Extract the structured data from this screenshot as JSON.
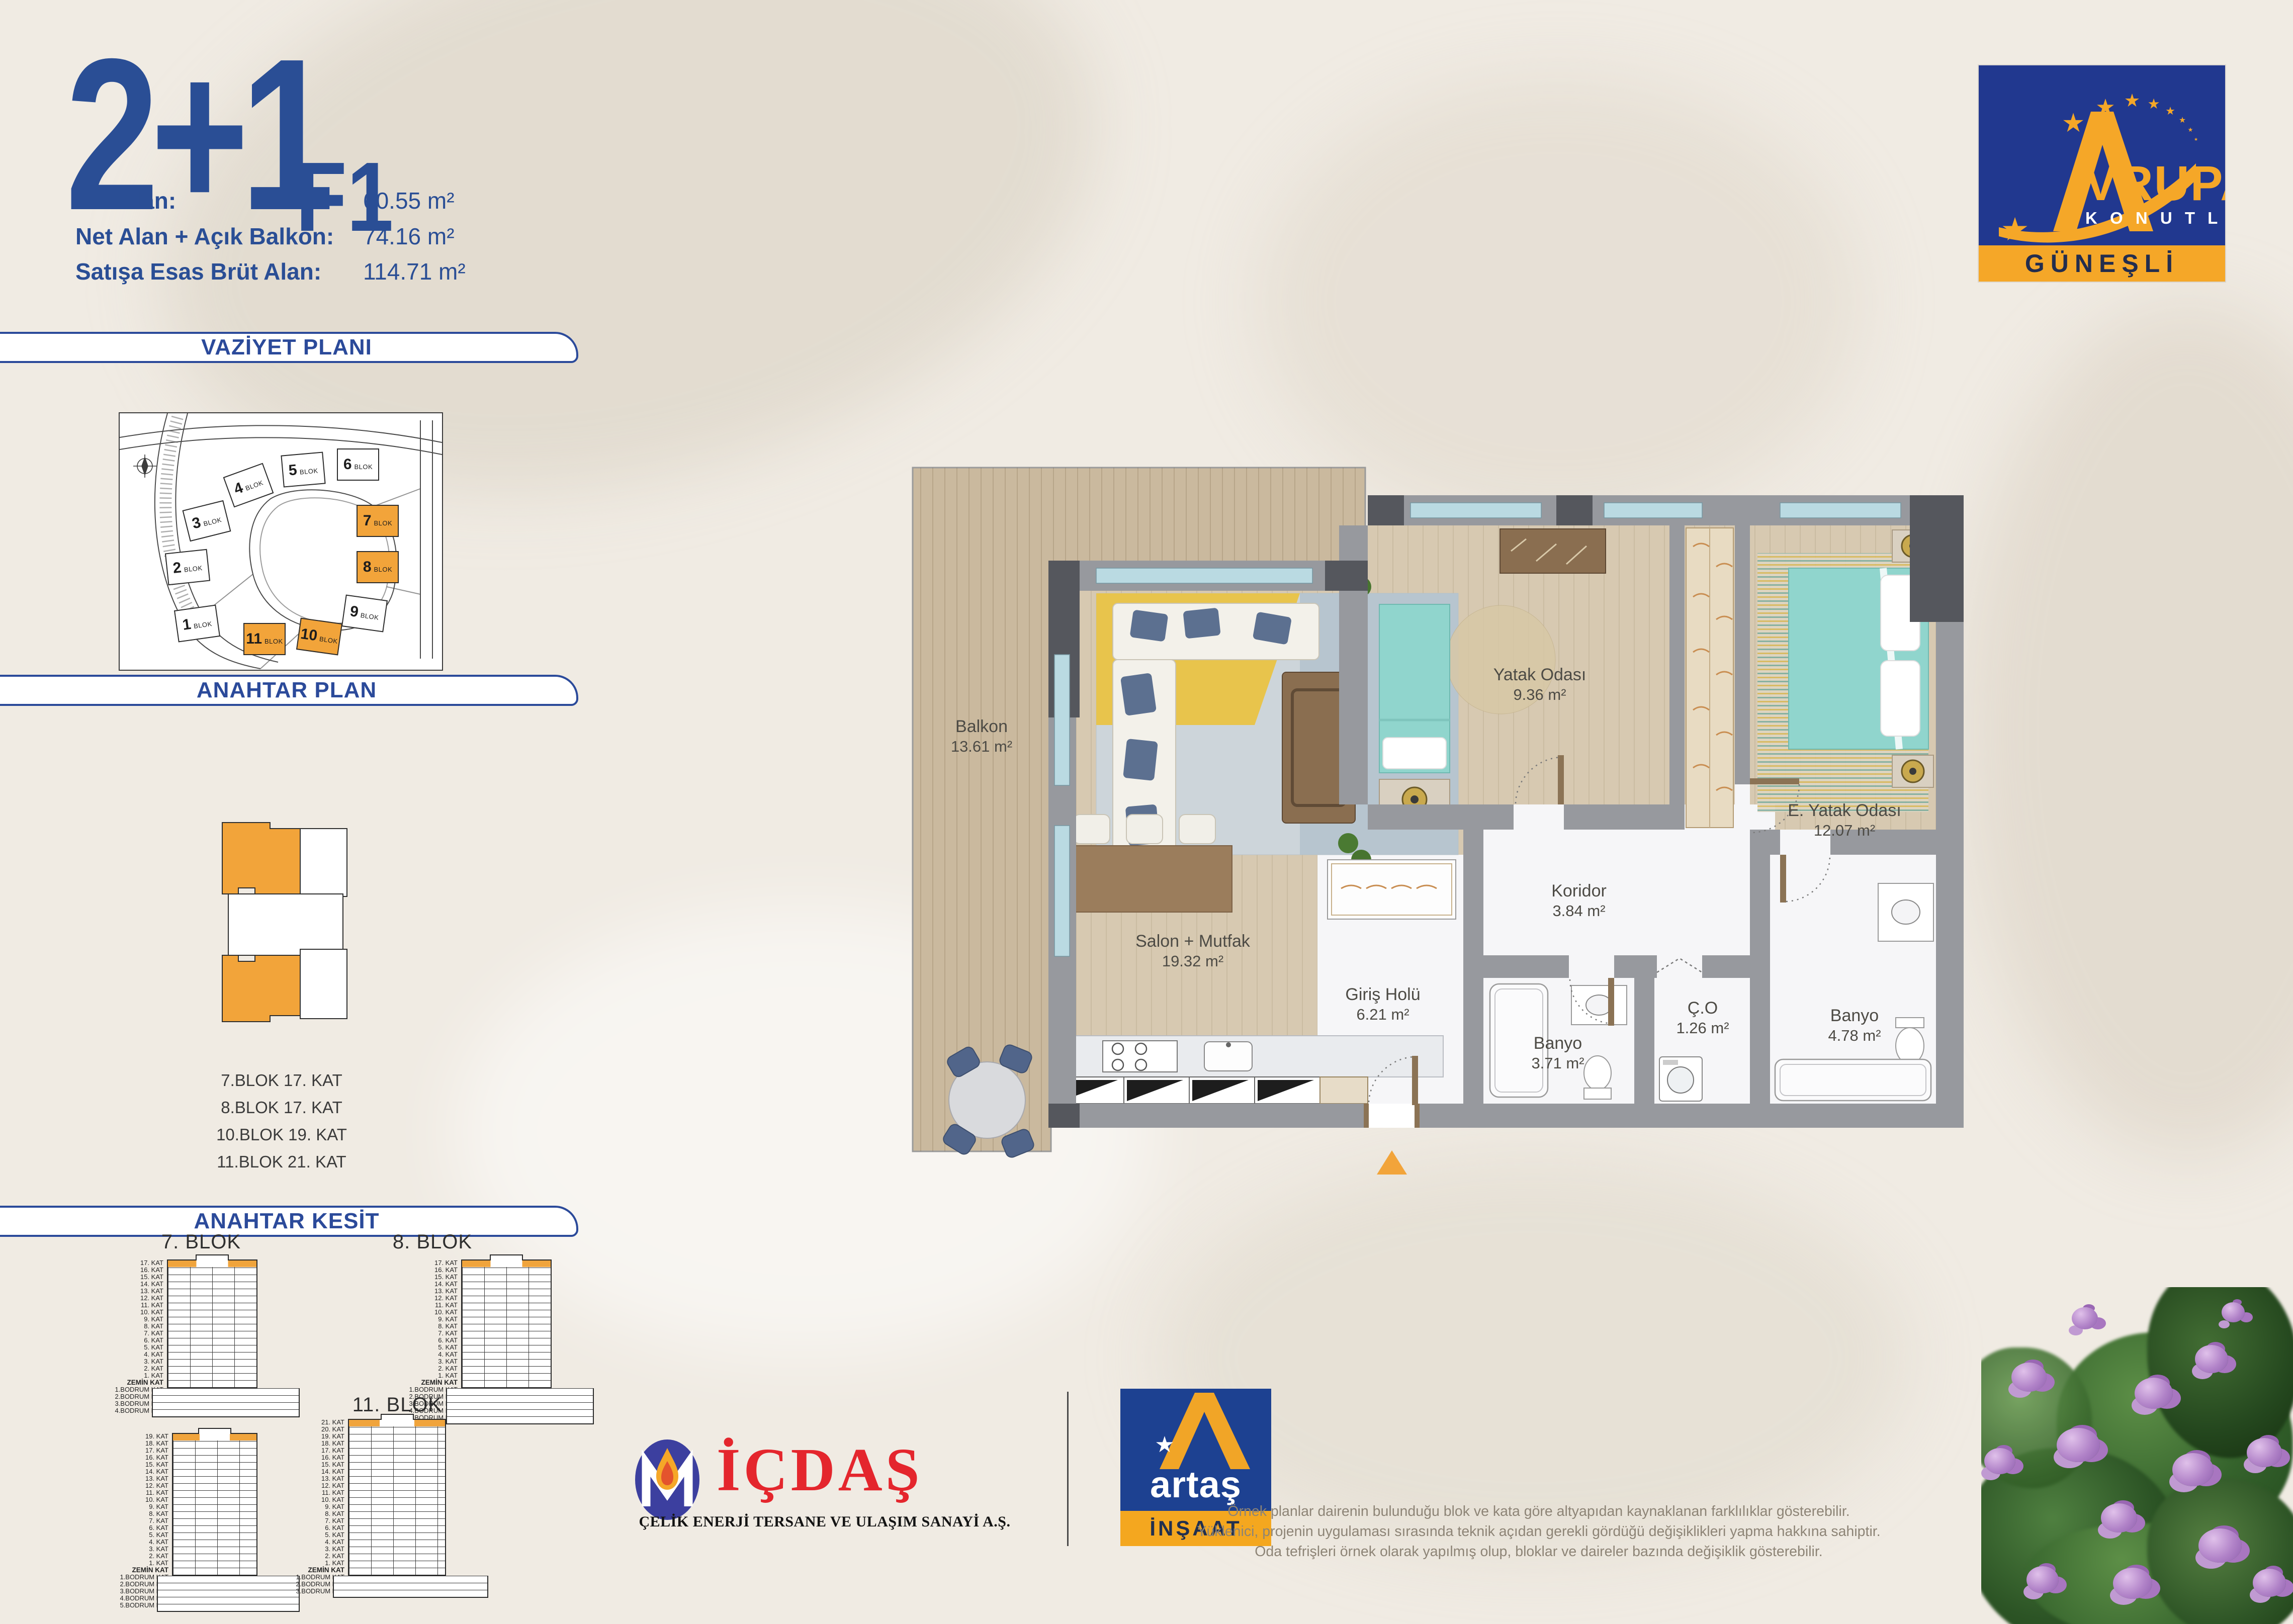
{
  "title": {
    "main": "2+1",
    "variant": "F1"
  },
  "stats": [
    {
      "label": "Net Alan:",
      "value": "60.55 m²"
    },
    {
      "label": "Net Alan + Açık Balkon:",
      "value": "74.16 m²"
    },
    {
      "label": "Satışa Esas Brüt Alan:",
      "value": "114.71 m²"
    }
  ],
  "sections": {
    "vaziyet": "VAZİYET PLANI",
    "anahtar_plan": "ANAHTAR PLAN",
    "anahtar_kesit": "ANAHTAR KESİT"
  },
  "siteplan": {
    "blocks": [
      {
        "num": "1",
        "label": "BLOK",
        "highlight": false
      },
      {
        "num": "2",
        "label": "BLOK",
        "highlight": false
      },
      {
        "num": "3",
        "label": "BLOK",
        "highlight": false
      },
      {
        "num": "4",
        "label": "BLOK",
        "highlight": false
      },
      {
        "num": "5",
        "label": "BLOK",
        "highlight": false
      },
      {
        "num": "6",
        "label": "BLOK",
        "highlight": false
      },
      {
        "num": "7",
        "label": "BLOK",
        "highlight": true
      },
      {
        "num": "8",
        "label": "BLOK",
        "highlight": true
      },
      {
        "num": "9",
        "label": "BLOK",
        "highlight": false
      },
      {
        "num": "10",
        "label": "BLOK",
        "highlight": true
      },
      {
        "num": "11",
        "label": "BLOK",
        "highlight": true
      }
    ]
  },
  "keyplan": {
    "lines": [
      "7.BLOK 17. KAT",
      "8.BLOK 17. KAT",
      "10.BLOK 19. KAT",
      "11.BLOK 21. KAT"
    ]
  },
  "kesit": {
    "towers": [
      {
        "name": "7. BLOK",
        "floors": [
          "17. KAT",
          "16. KAT",
          "15. KAT",
          "14. KAT",
          "13. KAT",
          "12. KAT",
          "11. KAT",
          "10. KAT",
          "9. KAT",
          "8. KAT",
          "7. KAT",
          "6. KAT",
          "5. KAT",
          "4. KAT",
          "3. KAT",
          "2. KAT",
          "1. KAT",
          "ZEMİN KAT",
          "1.BODRUM KAT",
          "2.BODRUM KAT",
          "3.BODRUM KAT",
          "4.BODRUM KAT"
        ]
      },
      {
        "name": "8. BLOK",
        "floors": [
          "17. KAT",
          "16. KAT",
          "15. KAT",
          "14. KAT",
          "13. KAT",
          "12. KAT",
          "11. KAT",
          "10. KAT",
          "9. KAT",
          "8. KAT",
          "7. KAT",
          "6. KAT",
          "5. KAT",
          "4. KAT",
          "3. KAT",
          "2. KAT",
          "1. KAT",
          "ZEMİN KAT",
          "1.BODRUM KAT",
          "2.BODRUM KAT",
          "3.BODRUM KAT",
          "4.BODRUM KAT",
          "5.BODRUM KAT"
        ]
      },
      {
        "name": "10. BLOK",
        "floors": [
          "19. KAT",
          "18. KAT",
          "17. KAT",
          "16. KAT",
          "15. KAT",
          "14. KAT",
          "13. KAT",
          "12. KAT",
          "11. KAT",
          "10. KAT",
          "9. KAT",
          "8. KAT",
          "7. KAT",
          "6. KAT",
          "5. KAT",
          "4. KAT",
          "3. KAT",
          "2. KAT",
          "1. KAT",
          "ZEMİN KAT",
          "1.BODRUM KAT",
          "2.BODRUM KAT",
          "3.BODRUM KAT",
          "4.BODRUM KAT",
          "5.BODRUM KAT"
        ]
      },
      {
        "name": "11. BLOK",
        "floors": [
          "21. KAT",
          "20. KAT",
          "19. KAT",
          "18. KAT",
          "17. KAT",
          "16. KAT",
          "15. KAT",
          "14. KAT",
          "13. KAT",
          "12. KAT",
          "11. KAT",
          "10. KAT",
          "9. KAT",
          "8. KAT",
          "7. KAT",
          "6. KAT",
          "5. KAT",
          "4. KAT",
          "3. KAT",
          "2. KAT",
          "1. KAT",
          "ZEMİN KAT",
          "1.BODRUM KAT",
          "2.BODRUM KAT",
          "3.BODRUM KAT"
        ]
      }
    ]
  },
  "plan": {
    "rooms": [
      {
        "name": "Balkon",
        "area": "13.61 m²"
      },
      {
        "name": "Salon + Mutfak",
        "area": "19.32 m²"
      },
      {
        "name": "Yatak Odası",
        "area": "9.36 m²"
      },
      {
        "name": "E. Yatak Odası",
        "area": "12.07 m²"
      },
      {
        "name": "Koridor",
        "area": "3.84 m²"
      },
      {
        "name": "Giriş Holü",
        "area": "6.21 m²"
      },
      {
        "name": "Banyo",
        "area": "3.71 m²"
      },
      {
        "name": "Ç.O",
        "area": "1.26 m²"
      },
      {
        "name": "Banyo",
        "area": "4.78 m²"
      }
    ]
  },
  "brand": {
    "name_rest": "VRUPA",
    "konutlari": "K O N U T L A R I",
    "location": "GÜNEŞLİ"
  },
  "partners": {
    "icdas": {
      "name": "İÇDAŞ",
      "subtitle": "ÇELİK ENERJİ TERSANE VE ULAŞIM SANAYİ A.Ş."
    },
    "artas": {
      "name": "artaş",
      "subtitle": "İNŞAAT"
    }
  },
  "disclaimer": {
    "lines": [
      "Örnek planlar dairenin bulunduğu blok ve kata göre altyapıdan kaynaklanan farklılıklar gösterebilir.",
      "Yüklenici, projenin uygulaması sırasında teknik açıdan gerekli gördüğü değişiklikleri yapma hakkına sahiptir.",
      "Oda tefrişleri örnek olarak yapılmış olup, bloklar ve daireler bazında değişiklik gösterebilir."
    ]
  },
  "colors": {
    "accent_blue": "#2b4a9a",
    "highlight_orange": "#f2a43a",
    "logo_blue": "#21388f",
    "logo_orange": "#f5a728",
    "icdas_red": "#e4262d"
  }
}
